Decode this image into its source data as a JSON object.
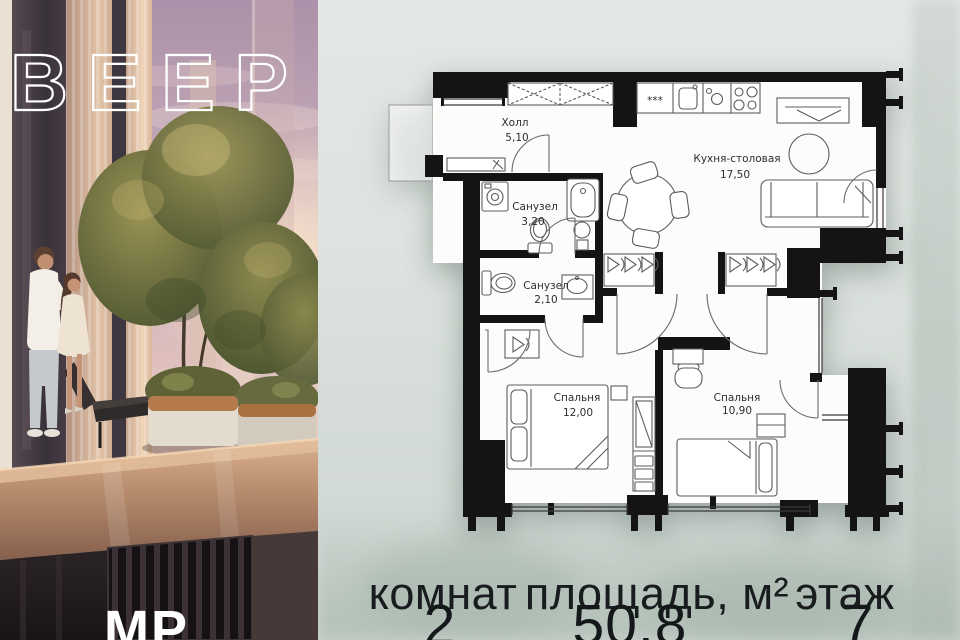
{
  "brand": {
    "logo_text": "ВЕЕР",
    "partial_mark": "МР"
  },
  "floorplan": {
    "rooms": [
      {
        "name": "Холл",
        "area": "5,10"
      },
      {
        "name": "Санузел",
        "area": "3,20"
      },
      {
        "name": "Санузел",
        "area": "2,10"
      },
      {
        "name": "Кухня-столовая",
        "area": "17,50"
      },
      {
        "name": "Спальня",
        "area": "12,00"
      },
      {
        "name": "Спальня",
        "area": "10,90"
      }
    ],
    "icons": {
      "fridge_glyph": "***"
    }
  },
  "summary": {
    "rooms_label": "комнат",
    "rooms_value": "2",
    "area_label": "площадь, м²",
    "area_value": "50,8",
    "floor_label": "этаж",
    "floor_value": "7"
  },
  "colors": {
    "wall": "#141414",
    "plan_floor": "#fcfcfa",
    "background": "#dbe1dd",
    "text": "#15181a",
    "logo": "#ffffff"
  }
}
